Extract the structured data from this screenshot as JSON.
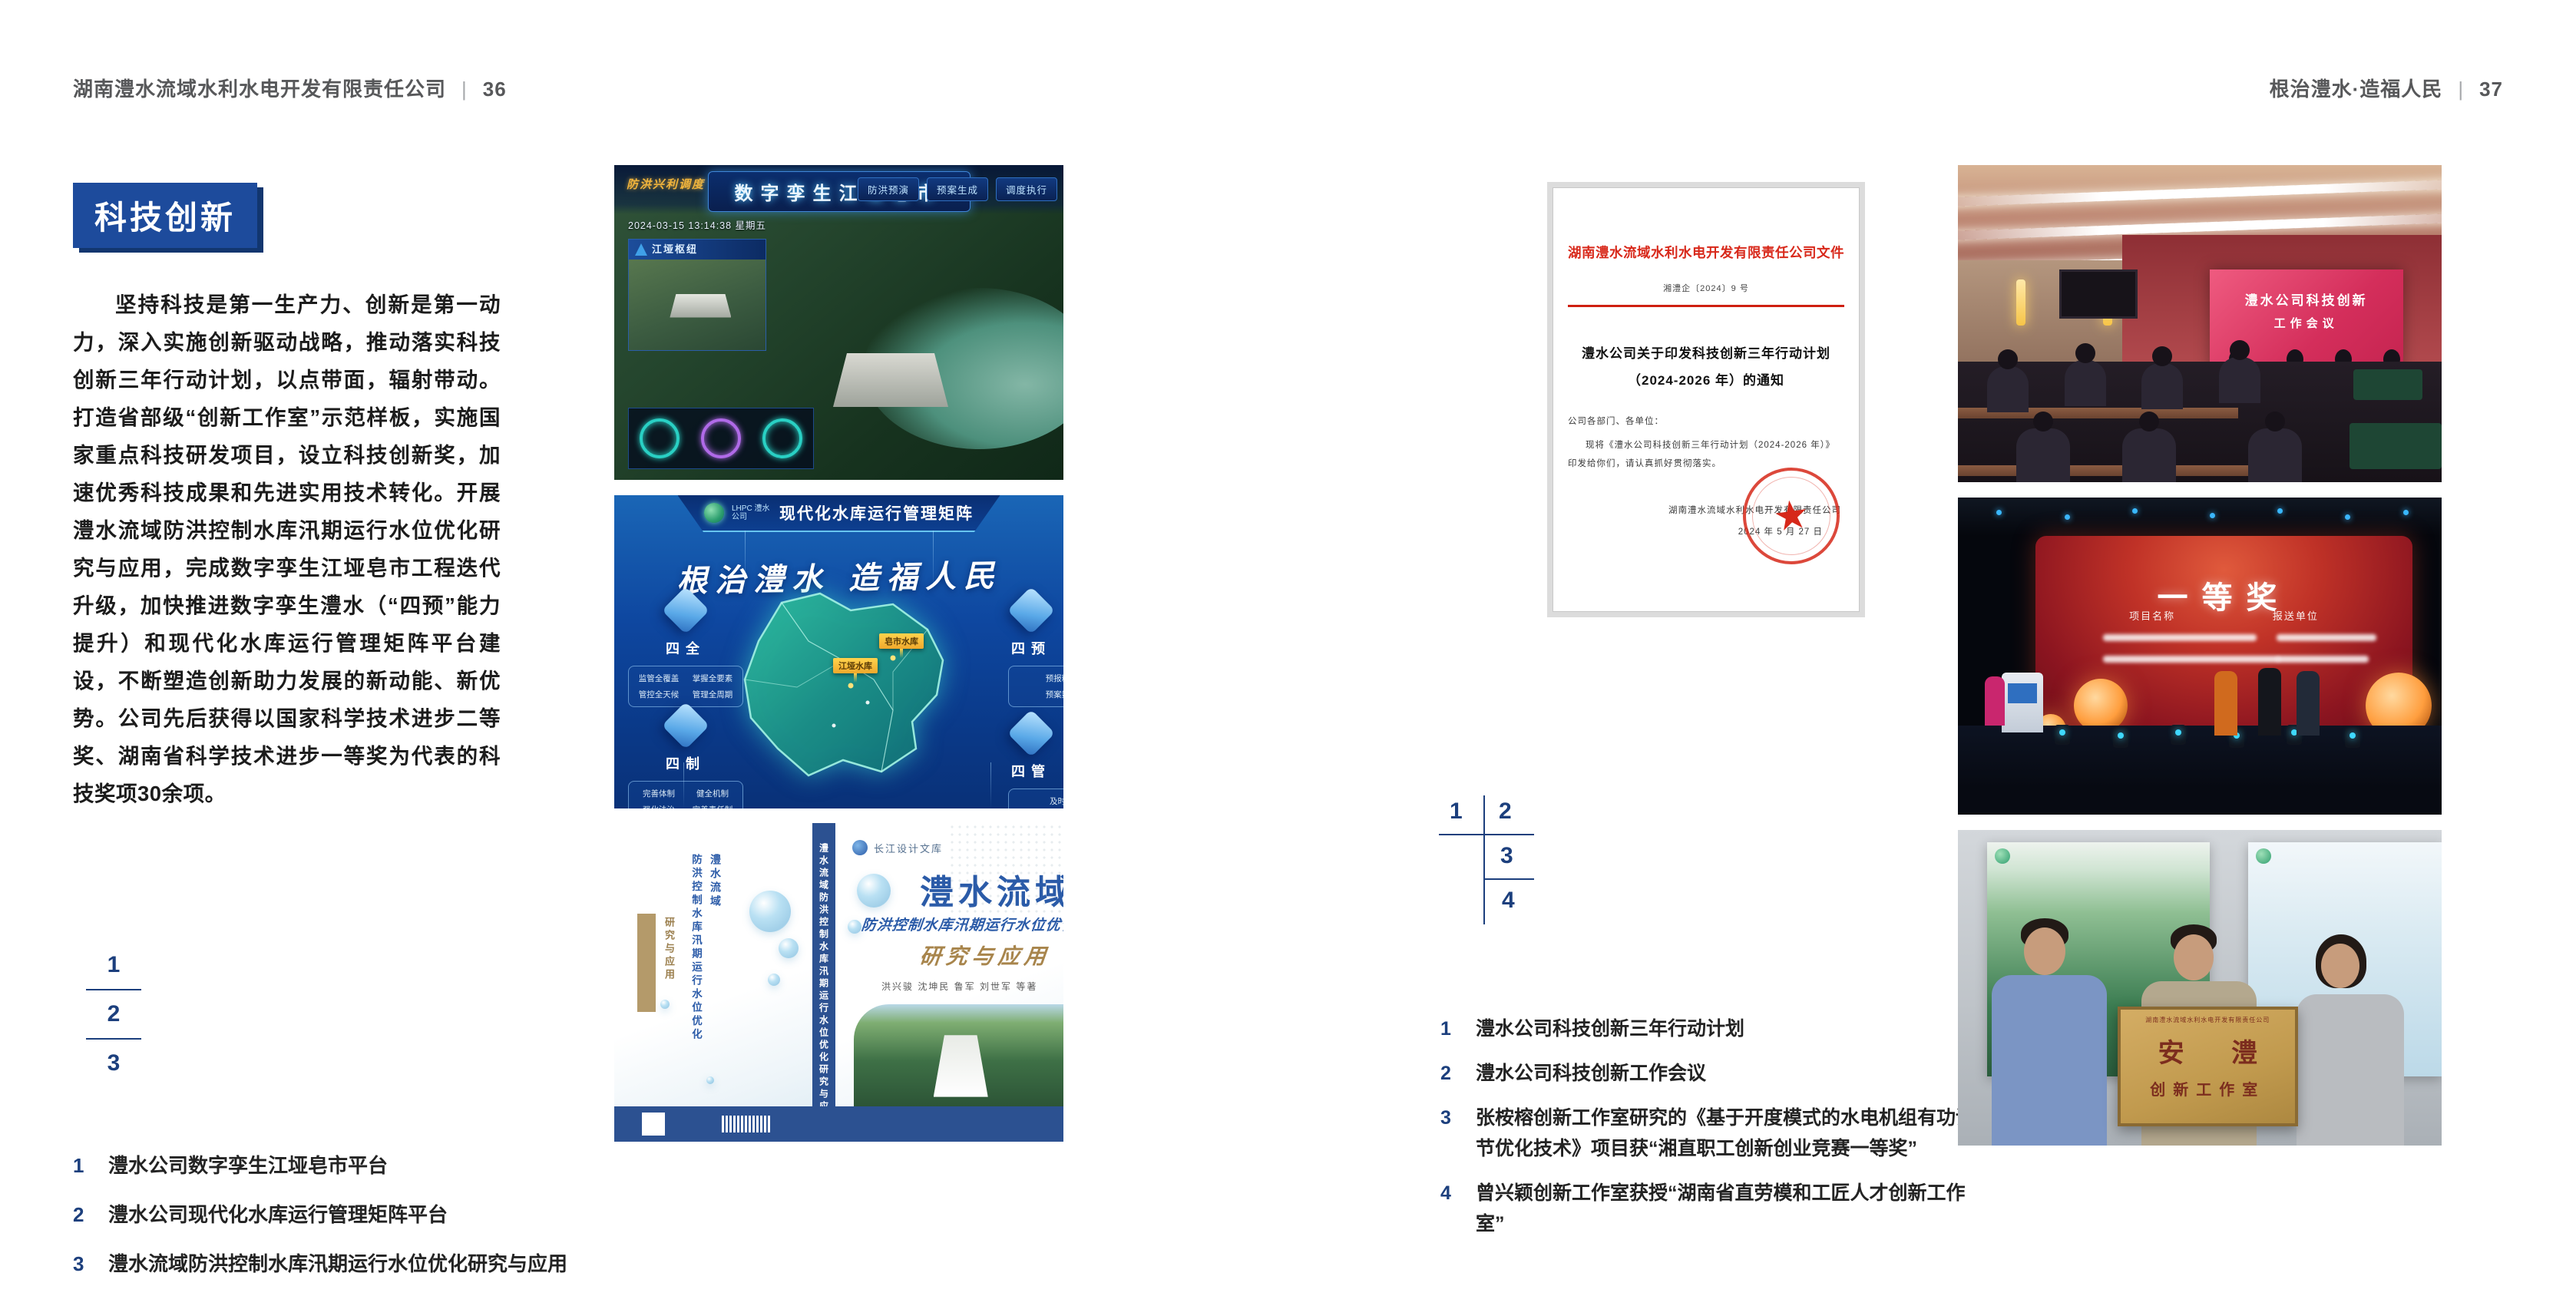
{
  "page_left": {
    "header": {
      "company": "湖南澧水流域水利水电开发有限责任公司",
      "divider": "|",
      "page_number": "36"
    },
    "section_badge": "科技创新",
    "body_paragraph": "坚持科技是第一生产力、创新是第一动力，深入实施创新驱动战略，推动落实科技创新三年行动计划，以点带面，辐射带动。打造省部级“创新工作室”示范样板，实施国家重点科技研发项目，设立科技创新奖，加速优秀科技成果和先进实用技术转化。开展澧水流域防洪控制水库汛期运行水位优化研究与应用，完成数字孪生江垭皂市工程迭代升级，加快推进数字孪生澧水（“四预”能力提升）和现代化水库运行管理矩阵平台建设，不断塑造创新助力发展的新动能、新优势。公司先后获得以国家科学技术进步二等奖、湖南省科学技术进步一等奖为代表的科技奖项30余项。",
    "figure_markers": [
      "1",
      "2",
      "3"
    ],
    "captions": [
      {
        "num": "1",
        "text": "澧水公司数字孪生江垭皂市平台"
      },
      {
        "num": "2",
        "text": "澧水公司现代化水库运行管理矩阵平台"
      },
      {
        "num": "3",
        "text": "澧水流域防洪控制水库汛期运行水位优化研究与应用"
      }
    ],
    "figures": {
      "dashboard": {
        "title": "数字孪生江垭皂市",
        "corner_label": "防洪兴利调度",
        "left_tabs": [
          "实时监测",
          "洪水预报",
          "防洪预警"
        ],
        "right_tabs": [
          "防洪预演",
          "预案生成",
          "调度执行"
        ],
        "datetime": "2024-03-15 13:14:38 星期五",
        "panel_title": "江垭枢纽"
      },
      "matrix": {
        "logo_text": "LHPC 澧水公司",
        "title": "现代化水库运行管理矩阵",
        "slogan": "根治澧水 造福人民",
        "marker1": "江垭水库",
        "marker2": "皂市水库",
        "panel_siquan": {
          "label": "四全",
          "items": [
            "监管全覆盖",
            "掌握全要素",
            "管控全天候",
            "管理全周期"
          ]
        },
        "panel_sizhi": {
          "label": "四制",
          "items": [
            "完善体制",
            "健全机制",
            "强化法治",
            "完善责任制"
          ]
        },
        "panel_siyu": {
          "label": "四预",
          "items": [
            "预报精准化",
            "预案数字化"
          ]
        },
        "panel_siguan": {
          "label": "四管",
          "items": [
            "及时检修",
            "强化维护"
          ]
        }
      },
      "book": {
        "series": "长江设计文库",
        "title": "澧水流域",
        "subtitle": "防洪控制水库汛期运行水位优化",
        "subtitle2": "研究与应用",
        "authors": "洪兴骏 沈坤民 鲁军 刘世军 等著",
        "spine_text": "澧水流域防洪控制水库汛期运行水位优化研究与应用",
        "back_col1": "澧水流域",
        "back_col2": "防洪控制水库汛期运行水位优化",
        "back_col3": "研究与应用"
      }
    }
  },
  "page_right": {
    "header": {
      "slogan": "根治澧水·造福人民",
      "divider": "|",
      "page_number": "37"
    },
    "figure_markers": [
      "1",
      "2",
      "3",
      "4"
    ],
    "captions": [
      {
        "num": "1",
        "text": "澧水公司科技创新三年行动计划"
      },
      {
        "num": "2",
        "text": "澧水公司科技创新工作会议"
      },
      {
        "num": "3",
        "text": "张桉榕创新工作室研究的《基于开度模式的水电机组有功调节优化技术》项目获“湘直职工创新创业竞赛一等奖”"
      },
      {
        "num": "4",
        "text": "曾兴颖创新工作室获授“湖南省直劳模和工匠人才创新工作室”"
      }
    ],
    "figures": {
      "document": {
        "letterhead": "湖南澧水流域水利水电开发有限责任公司文件",
        "doc_number": "湘澧企〔2024〕9 号",
        "title_line1": "澧水公司关于印发科技创新三年行动计划",
        "title_line2": "（2024-2026 年）的通知",
        "salutation": "公司各部门、各单位：",
        "body": "现将《澧水公司科技创新三年行动计划（2024-2026 年）》印发给你们，请认真抓好贯彻落实。",
        "signature": "湖南澧水流域水利水电开发有限责任公司",
        "date": "2024 年 5 月 27 日",
        "seal_star": "★"
      },
      "meeting": {
        "screen_line1": "澧水公司科技创新",
        "screen_line2": "工作会议"
      },
      "award": {
        "screen_title": "一等奖",
        "col1": "项目名称",
        "col2": "报送单位"
      },
      "workshop": {
        "plaque_header": "湖南澧水流域水利水电开发有限责任公司",
        "plaque_title": "安 澧",
        "plaque_subtitle": "创新工作室"
      }
    }
  }
}
